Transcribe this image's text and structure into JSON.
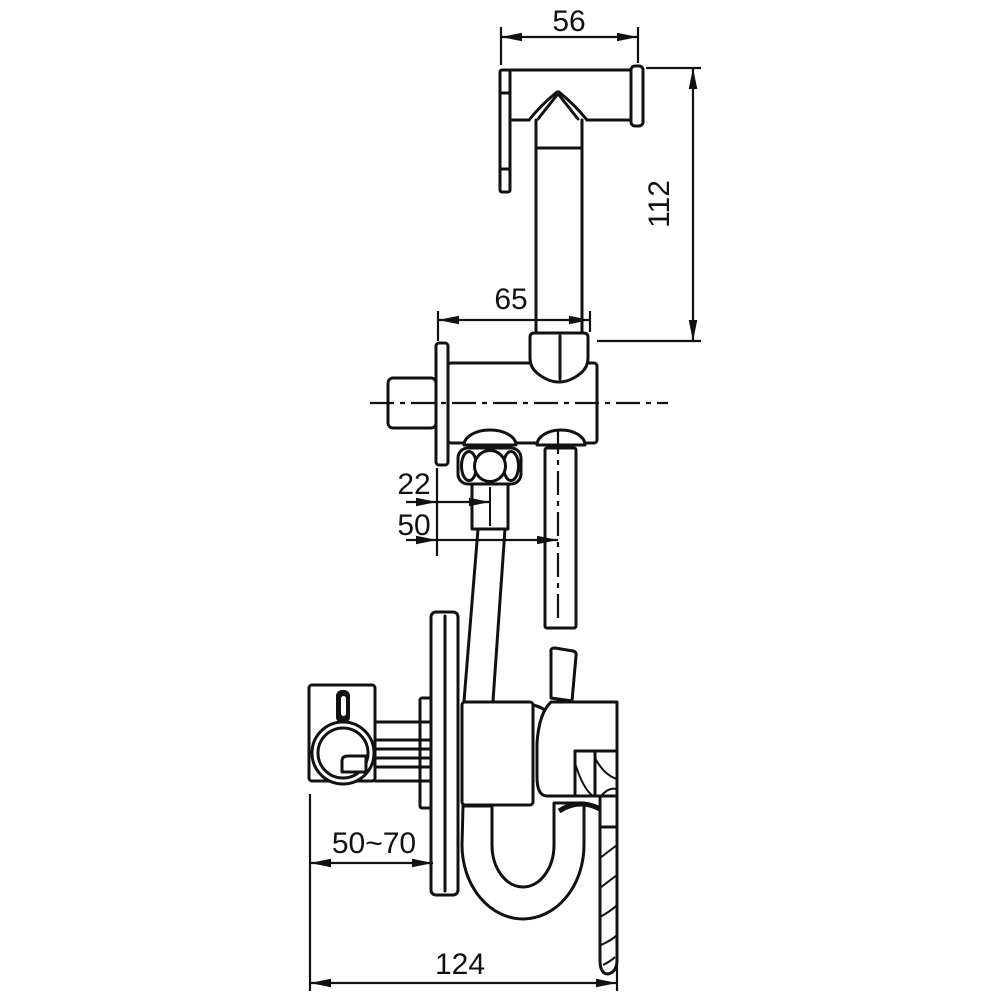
{
  "colors": {
    "background": "#ffffff",
    "line": "#111111"
  },
  "dimensions": {
    "head_width": "56",
    "sprayer_height": "112",
    "holder_depth": "65",
    "hose_outlet_offset": "22",
    "sprayer_axis_offset": "50",
    "mount_depth_range": "50~70",
    "overall_width": "124"
  }
}
